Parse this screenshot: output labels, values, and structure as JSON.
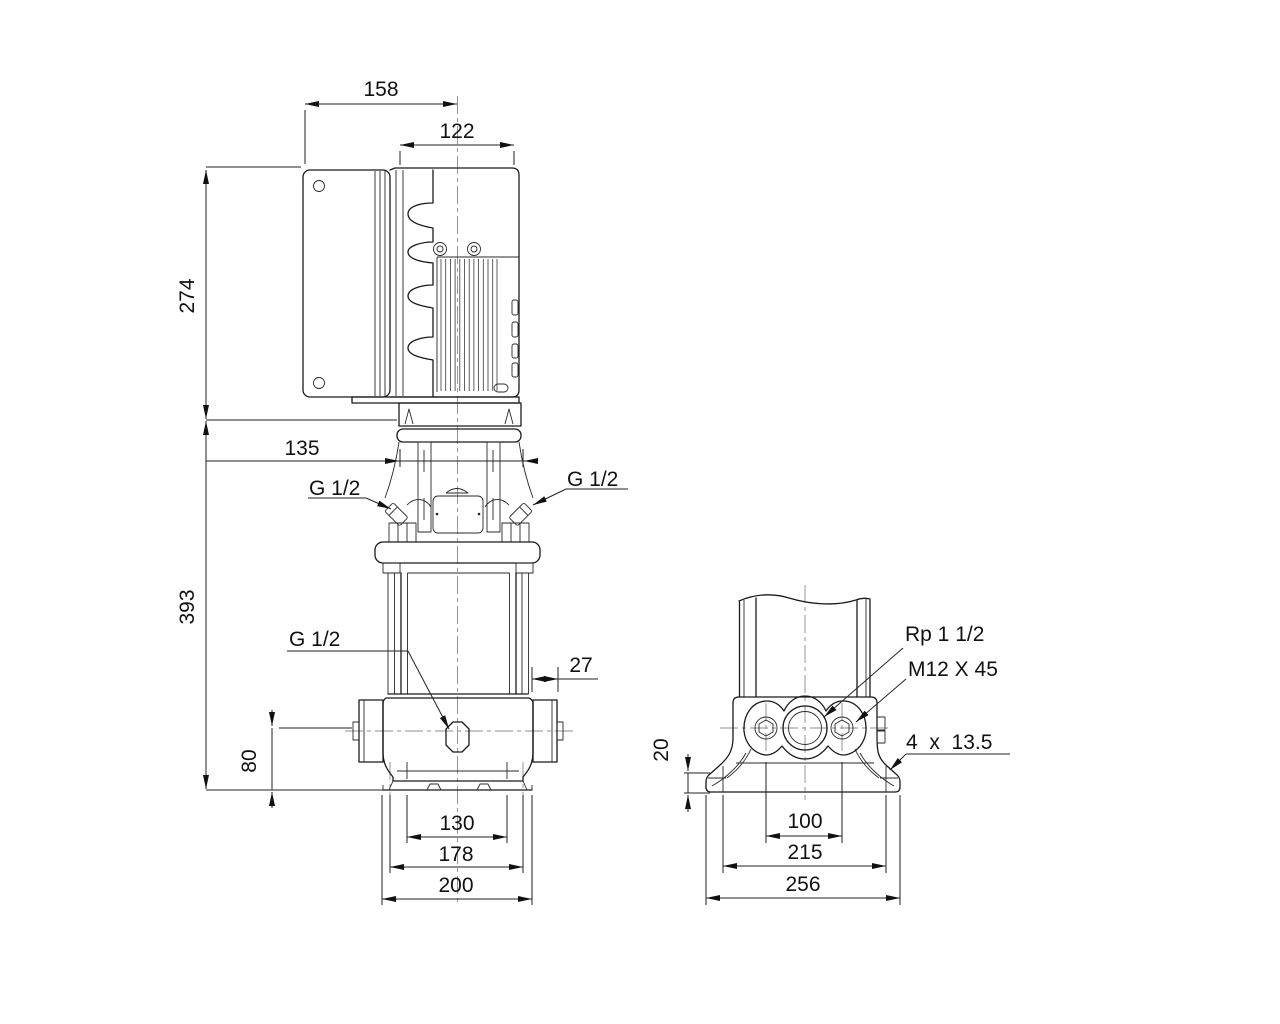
{
  "drawing": {
    "background": "#ffffff",
    "line_color": "#1a1a1a",
    "centerline_color": "#8c8c8c",
    "type": "pump dimensional drawing, front and side views"
  },
  "front_view": {
    "dim_158": "158",
    "dim_122": "122",
    "dim_274": "274",
    "dim_135": "135",
    "dim_393": "393",
    "dim_80": "80",
    "dim_27": "27",
    "dim_130": "130",
    "dim_178": "178",
    "dim_200": "200",
    "label_g12_left": "G 1/2",
    "label_g12_right": "G 1/2",
    "label_g12_drain": "G 1/2"
  },
  "side_view": {
    "label_rp": "Rp 1 1/2",
    "label_bolt": "M12 X 45",
    "label_slots": "4  x  13.5",
    "dim_20": "20",
    "dim_100": "100",
    "dim_215": "215",
    "dim_256": "256"
  }
}
